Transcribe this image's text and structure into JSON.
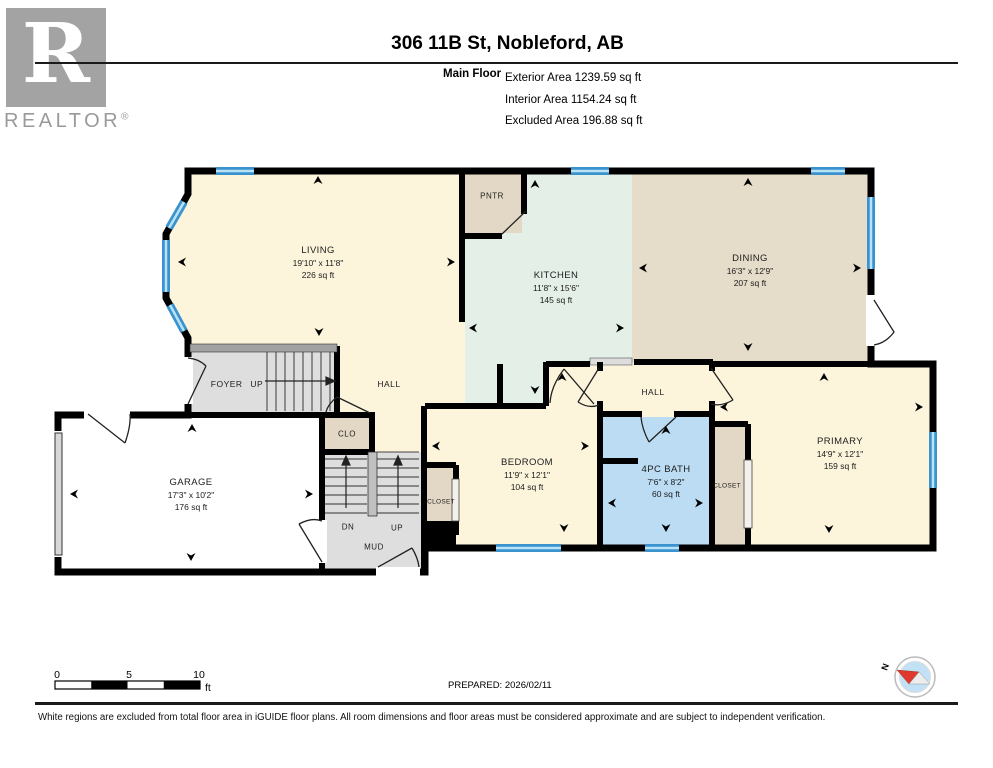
{
  "logo": {
    "brand": "REALTOR",
    "registered": "®",
    "r_letter": "R"
  },
  "header": {
    "title": "306 11B St, Nobleford, AB",
    "floor_label": "Main Floor",
    "area_lines": [
      "Exterior Area 1239.59 sq ft",
      "Interior Area 1154.24 sq ft",
      "Excluded Area 196.88 sq ft"
    ]
  },
  "rooms": [
    {
      "name": "LIVING",
      "dims": "19'10\" x 11'8\"",
      "area": "226 sq ft"
    },
    {
      "name": "KITCHEN",
      "dims": "11'8\" x 15'6\"",
      "area": "145 sq ft"
    },
    {
      "name": "DINING",
      "dims": "16'3\" x 12'9\"",
      "area": "207 sq ft"
    },
    {
      "name": "GARAGE",
      "dims": "17'3\" x 10'2\"",
      "area": "176 sq ft"
    },
    {
      "name": "BEDROOM",
      "dims": "11'9\" x 12'1\"",
      "area": "104 sq ft"
    },
    {
      "name": "4PC BATH",
      "dims": "7'6\" x 8'2\"",
      "area": "60 sq ft"
    },
    {
      "name": "PRIMARY",
      "dims": "14'9\" x 12'1\"",
      "area": "159 sq ft"
    }
  ],
  "labels": {
    "pantry": "PNTR",
    "foyer": "FOYER UP",
    "hall_main": "HALL",
    "hall_back": "HALL",
    "clo": "CLO",
    "closet_bedroom": "CLOSET",
    "closet_primary": "CLOSET",
    "stairs_down": "DN",
    "stairs_up": "UP",
    "mud": "MUD"
  },
  "scale_bar": {
    "ticks": [
      "0",
      "5",
      "10"
    ],
    "unit": "ft"
  },
  "prepared": "PREPARED: 2026/02/11",
  "compass": {
    "north_label": "N"
  },
  "footer": {
    "disclaimer": "White regions are excluded from total floor area in iGUIDE floor plans. All room dimensions and floor areas must be considered approximate and are subject to independent verification."
  },
  "colors": {
    "wall": "#000000",
    "room_cream": "#FCF5DC",
    "kitchen_mint": "#E4EFE8",
    "dining_tan": "#E5DCC9",
    "bath_blue": "#BCDCF4",
    "closet_tan": "#E3D8C6",
    "stairs_gray": "#DEDEDE",
    "garage_white": "#FFFFFF",
    "window_blue": "#3A93CF",
    "window_light": "#B8E2F5",
    "logo_gray": "#A3A3A3",
    "compass_red": "#E03A2F",
    "compass_blue": "#C3E1F5"
  }
}
